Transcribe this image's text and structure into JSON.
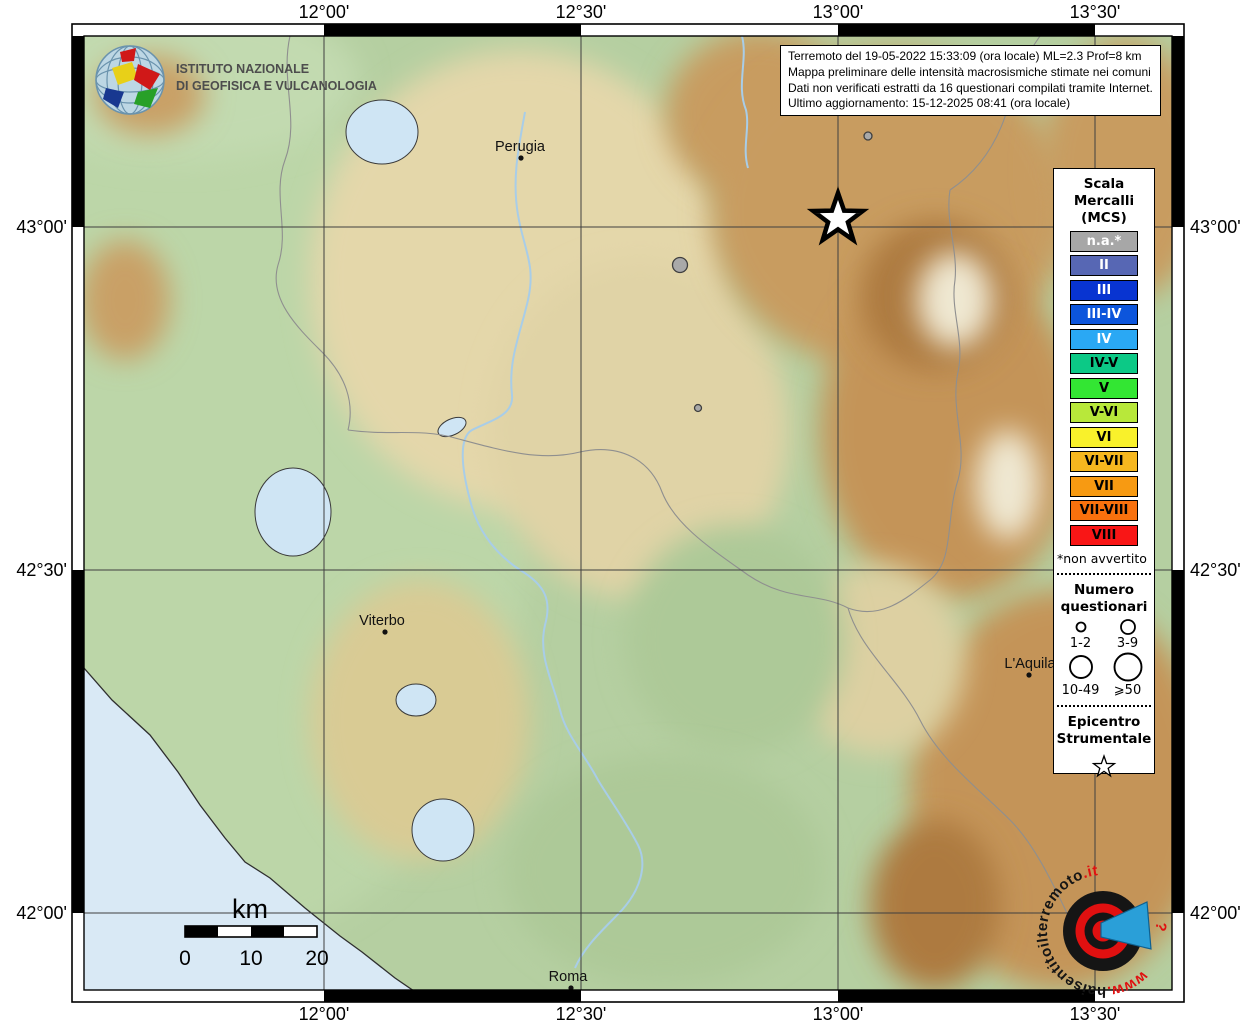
{
  "title_box": {
    "lines": [
      "Terremoto del 19-05-2022 15:33:09 (ora locale) ML=2.3 Prof=8 km",
      "Mappa preliminare delle intensità macrosismiche stimate nei comuni",
      "Dati non verificati estratti da 16 questionari compilati tramite Internet.",
      "Ultimo aggiornamento: 15-12-2025 08:41 (ora locale)"
    ]
  },
  "ingv_logo": {
    "line1": "ISTITUTO NAZIONALE",
    "line2": "DI GEOFISICA E VULCANOLOGIA"
  },
  "map": {
    "axis": {
      "top": [
        "12°00'",
        "12°30'",
        "13°00'",
        "13°30'"
      ],
      "bottom": [
        "12°00'",
        "12°30'",
        "13°00'",
        "13°30'"
      ],
      "left": [
        "43°00'",
        "42°30'",
        "42°00'"
      ],
      "right": [
        "43°00'",
        "42°30'",
        "42°00'"
      ]
    },
    "cities": [
      {
        "name": "Perugia",
        "label_x": 520,
        "label_y": 151,
        "marker_x": 521,
        "marker_y": 158
      },
      {
        "name": "Viterbo",
        "label_x": 382,
        "label_y": 625,
        "marker_x": 385,
        "marker_y": 632
      },
      {
        "name": "L'Aquila",
        "label_x": 1030,
        "label_y": 668,
        "marker_x": 1029,
        "marker_y": 675
      },
      {
        "name": "Roma",
        "label_x": 568,
        "label_y": 981,
        "marker_x": 571,
        "marker_y": 988
      }
    ],
    "points": [
      {
        "x": 680,
        "y": 265,
        "r": 7.5,
        "intensity": "n.a.",
        "questionari_class": "10-49",
        "color": "#a9a9a9"
      },
      {
        "x": 868,
        "y": 136,
        "r": 4.0,
        "intensity": "n.a.",
        "questionari_class": "3-9",
        "color": "#a9a9a9"
      },
      {
        "x": 698,
        "y": 408,
        "r": 3.5,
        "intensity": "n.a.",
        "questionari_class": "1-2",
        "color": "#a9a9a9"
      }
    ],
    "epicenter": {
      "x": 838,
      "y": 219
    }
  },
  "legend": {
    "title_lines": [
      "Scala",
      "Mercalli",
      "(MCS)"
    ],
    "scale": [
      {
        "label": "n.a.*",
        "color": "#a7a7a7",
        "text_color": "#ffffff"
      },
      {
        "label": "II",
        "color": "#5767b4",
        "text_color": "#ffffff"
      },
      {
        "label": "III",
        "color": "#0834d1",
        "text_color": "#ffffff"
      },
      {
        "label": "III-IV",
        "color": "#0c55dc",
        "text_color": "#ffffff"
      },
      {
        "label": "IV",
        "color": "#2aa8f4",
        "text_color": "#ffffff"
      },
      {
        "label": "IV-V",
        "color": "#0cc986",
        "text_color": "#000000"
      },
      {
        "label": "V",
        "color": "#33e633",
        "text_color": "#000000"
      },
      {
        "label": "V-VI",
        "color": "#b8e83a",
        "text_color": "#000000"
      },
      {
        "label": "VI",
        "color": "#f9f12b",
        "text_color": "#000000"
      },
      {
        "label": "VI-VII",
        "color": "#f6b71f",
        "text_color": "#000000"
      },
      {
        "label": "VII",
        "color": "#f79a12",
        "text_color": "#000000"
      },
      {
        "label": "VII-VIII",
        "color": "#f9710d",
        "text_color": "#000000"
      },
      {
        "label": "VIII",
        "color": "#f91616",
        "text_color": "#000000"
      }
    ],
    "footnote": "*non avvertito",
    "questionari": {
      "title_line1": "Numero",
      "title_line2": "questionari",
      "sizes": [
        {
          "label": "1-2",
          "r": 4.5
        },
        {
          "label": "3-9",
          "r": 7
        },
        {
          "label": "10-49",
          "r": 11
        },
        {
          "label": "⩾50",
          "r": 13.5
        }
      ]
    },
    "epicentro": {
      "line1": "Epicentro",
      "line2": "Strumentale"
    }
  },
  "scalebar": {
    "unit": "km",
    "labels": [
      "0",
      "10",
      "20"
    ]
  },
  "site_logo": {
    "www": "www.",
    "hai": "haisentito",
    "il": "il",
    "terremoto": "terremoto",
    "it": ".it",
    "question": "?",
    "red": "#e01010",
    "black": "#151515",
    "blue": "#2a9fd8"
  }
}
